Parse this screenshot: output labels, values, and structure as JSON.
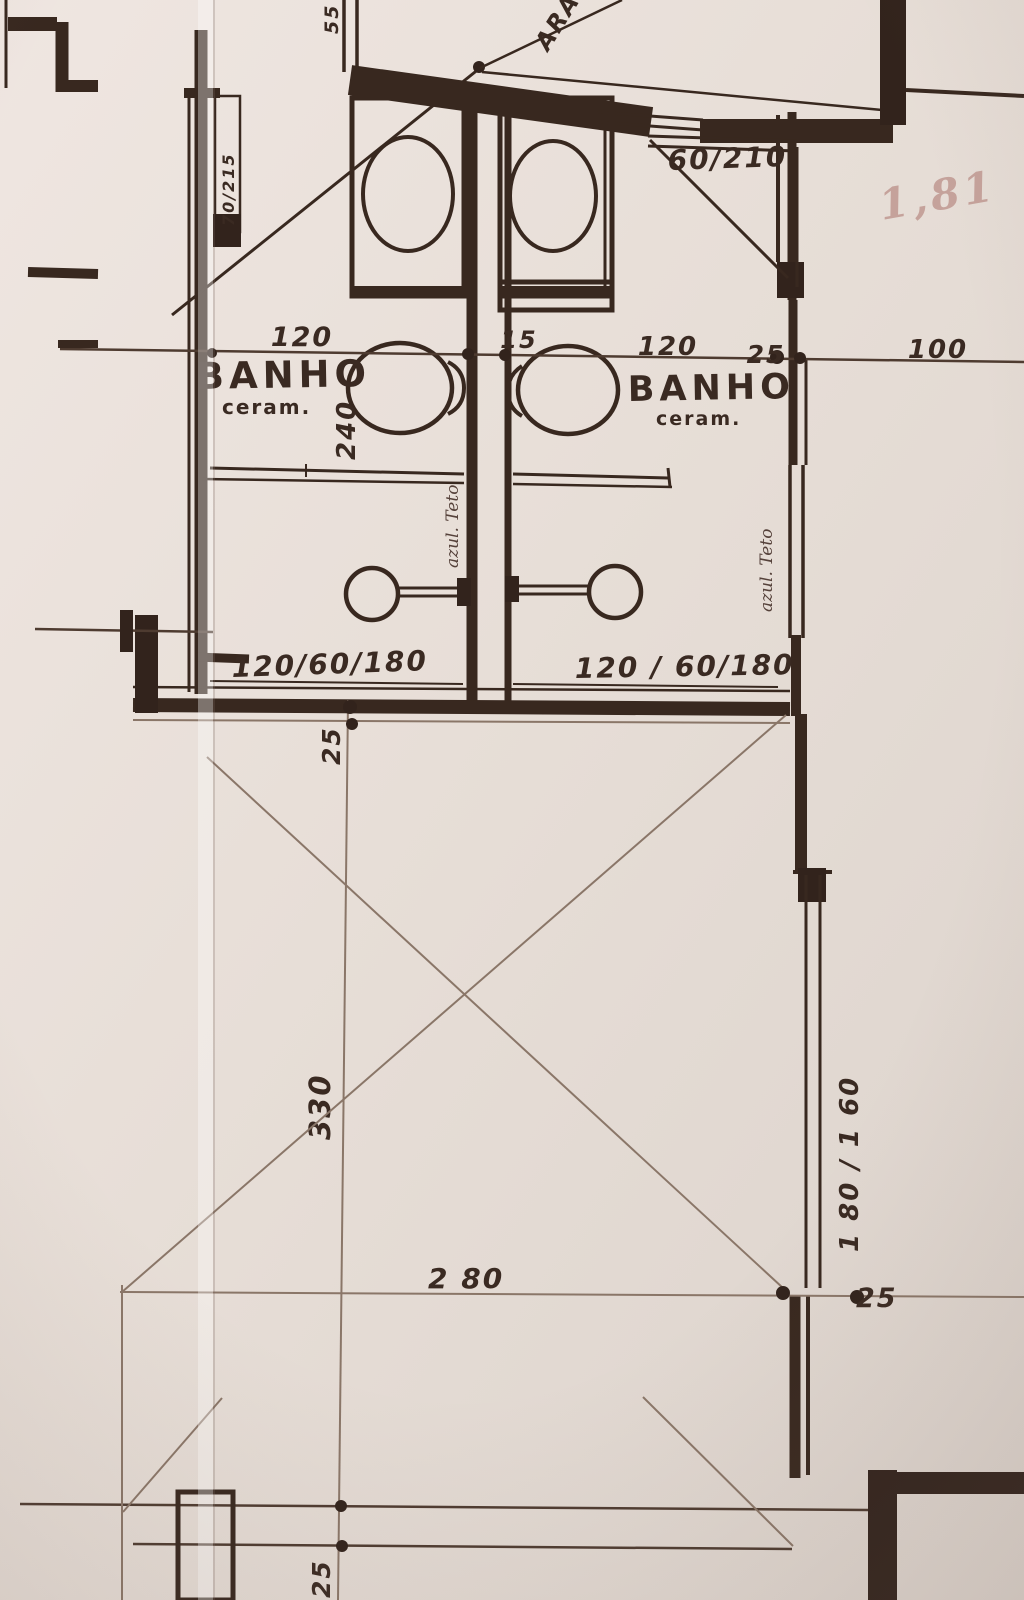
{
  "drawing": {
    "rooms": {
      "bath_left": {
        "name": "BANHO",
        "finish": "ceram.",
        "tile_note": "azul. Teto"
      },
      "bath_right": {
        "name": "BANHO",
        "finish": "ceram.",
        "tile_note": "azul. Teto"
      }
    },
    "doors": {
      "left_spec": "70/215",
      "right_spec": "60/210"
    },
    "windows": {
      "bath_left_spec": "120/60/180",
      "bath_right_spec": "120 / 60/180",
      "bedroom_right_spec": "1 80 / 1 60"
    },
    "dimensions": {
      "d55": "55",
      "d120_left": "120",
      "d15": "15",
      "d120_right": "120",
      "d25_top": "25",
      "d100": "100",
      "d240": "240",
      "d25_mid": "25",
      "d330": "330",
      "d280": "2 80",
      "d25_right": "25",
      "d25_bottom": "25"
    },
    "annotations": {
      "closet": "ARA",
      "pencil": "1,81"
    },
    "colors": {
      "ink": "#38281f",
      "pencil": "#8a7668",
      "paper": "#e6ddd6",
      "pencil_note": "#c5a29b"
    }
  }
}
